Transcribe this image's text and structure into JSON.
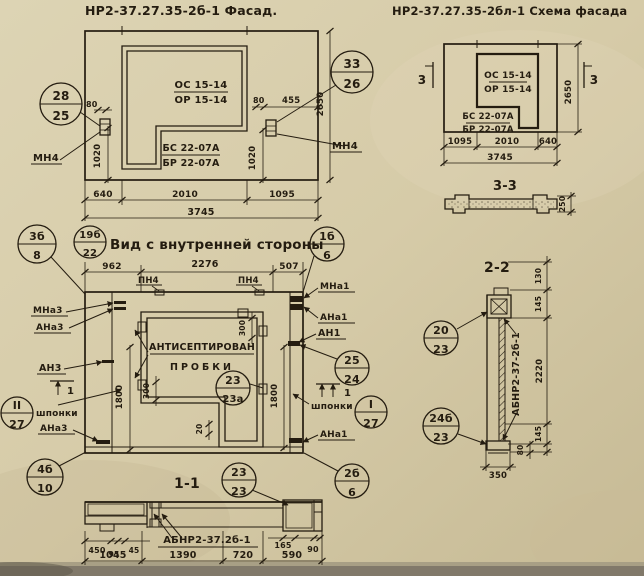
{
  "colors": {
    "paper": "#d6cba8",
    "paper_light": "#ddd4b4",
    "paper_dark": "#c6ba95",
    "ink": "#241c10",
    "bottom_strip": "#81796a"
  },
  "facade": {
    "title": "НР2-37.27.35-2б-1 Фасад.",
    "callout_28_25": {
      "top": "28",
      "bottom": "25"
    },
    "callout_33_26": {
      "top": "33",
      "bottom": "26"
    },
    "anchor_left": "МН4",
    "anchor_right": "МН4",
    "opening_top": {
      "line1": "ОС 15-14",
      "line2": "ОР 15-14"
    },
    "opening_bottom": {
      "line1": "БС 22-07А",
      "line2": "БР 22-07А"
    },
    "dims": {
      "left_offset": "80",
      "left_height": "1020",
      "right_offset": "80",
      "right_width": "455",
      "right_height": "1020",
      "height": "2650",
      "bottom": [
        "640",
        "2010",
        "1095"
      ],
      "total": "3745"
    }
  },
  "scheme": {
    "title": "НР2-37.27.35-2бл-1 Схема фасада",
    "opening_top": {
      "line1": "ОС 15-14",
      "line2": "ОР 15-14"
    },
    "opening_bottom": {
      "line1": "БС 22-07А",
      "line2": "БР 22-07А"
    },
    "section_mark": "3",
    "dims": {
      "height": "2650",
      "bottom": [
        "1095",
        "2010",
        "640"
      ],
      "total": "3745"
    }
  },
  "section33": {
    "title": "3-3",
    "dim_height": "250"
  },
  "inner_view": {
    "title": "Вид с внутренней стороны",
    "callout_3b_8": {
      "top": "3б",
      "bottom": "8"
    },
    "callout_19b_22": {
      "top": "19б",
      "bottom": "22"
    },
    "callout_1b_6": {
      "top": "1б",
      "bottom": "6"
    },
    "callout_II_27": {
      "top": "II",
      "bottom": "27"
    },
    "callout_4b_10": {
      "top": "4б",
      "bottom": "10"
    },
    "callout_23_23a": {
      "top": "23",
      "bottom": "23а"
    },
    "callout_25_24": {
      "top": "25",
      "bottom": "24"
    },
    "callout_I_27": {
      "top": "I",
      "bottom": "27"
    },
    "callout_2b_6": {
      "top": "2б",
      "bottom": "6"
    },
    "labels": {
      "pn4": "ПН4",
      "mna3": "МНа3",
      "ana3": "АНа3",
      "an3": "АН3",
      "shponki": "шпонки",
      "ana3_low": "АНа3",
      "mna1": "МНа1",
      "ana1": "АНа1",
      "an1": "АН1",
      "shponki_r": "шпонки",
      "ana1_low": "АНа1",
      "note1": "АНТИСЕПТИРОВАН",
      "note2": "ПРОБКИ",
      "section_mark": "1"
    },
    "dims": {
      "top": [
        "962",
        "2276",
        "507"
      ],
      "left_height": "1800",
      "right_height": "1800",
      "d300_top": "300",
      "d300_left": "300",
      "d20": "20"
    }
  },
  "section11": {
    "title": "1-1",
    "callout_23_23": {
      "top": "23",
      "bottom": "23"
    },
    "label": "АБНР2-37.2б-1",
    "dims": {
      "small_left": [
        "450",
        "95",
        "45"
      ],
      "small_right": [
        "165",
        "90"
      ],
      "bottom": [
        "1045",
        "1390",
        "720",
        "590"
      ]
    }
  },
  "section22": {
    "title": "2-2",
    "callout_20_23": {
      "top": "20",
      "bottom": "23"
    },
    "callout_24b_23": {
      "top": "24б",
      "bottom": "23"
    },
    "label": "АБНР2-37-2б-1",
    "dims": {
      "d130": "130",
      "d145_top": "145",
      "d2220": "2220",
      "d145_bot": "145",
      "d80": "80",
      "d350": "350"
    }
  }
}
